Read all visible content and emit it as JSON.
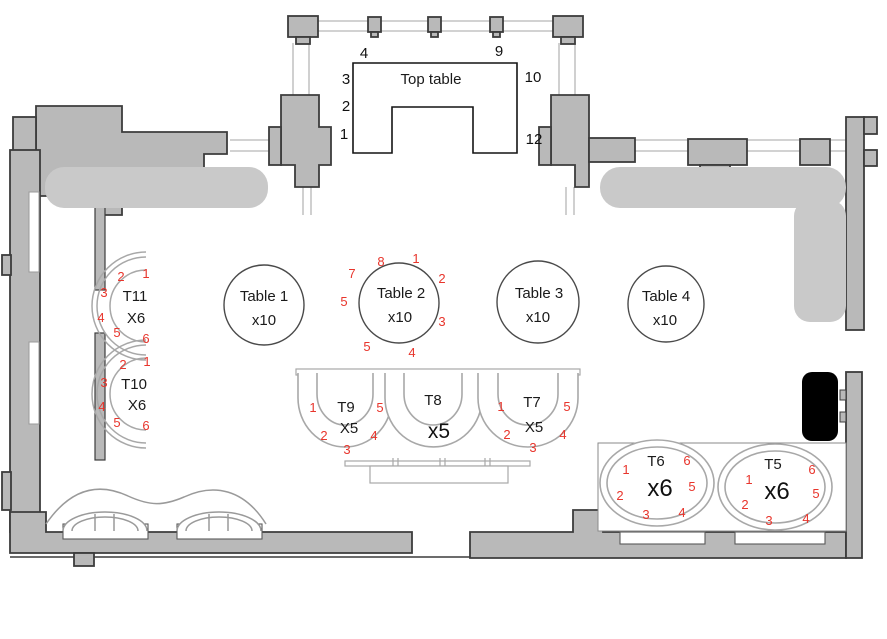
{
  "colors": {
    "wall_fill": "#b9b9b9",
    "wall_outline": "#3c3c3c",
    "thin_wall_line": "#c4c4c4",
    "lounge_fill": "#c9c9c9",
    "furniture_outline": "#a8a8a8",
    "table_outline": "#4a4a4a",
    "seat_number": "#e8352c",
    "label_text": "#1a1a1a",
    "black_object": "#000000"
  },
  "tables": {
    "top": {
      "label": "Top table",
      "seats": {
        "n4": "4",
        "n9": "9",
        "n3": "3",
        "n2": "2",
        "n1": "1",
        "n10": "10",
        "n12": "12"
      }
    },
    "t1": {
      "label": "Table 1",
      "cap": "x10"
    },
    "t2": {
      "label": "Table 2",
      "cap": "x10",
      "seats": {
        "top": "8",
        "top_right": "1",
        "upper_left": "7",
        "right": "2",
        "left": "5",
        "lower_right": "3",
        "bottom_left": "5",
        "bottom": "4"
      }
    },
    "t3": {
      "label": "Table 3",
      "cap": "x10"
    },
    "t4": {
      "label": "Table 4",
      "cap": "x10"
    },
    "t11": {
      "label": "T11",
      "cap": "X6",
      "seats": {
        "s1": "1",
        "s2": "2",
        "s3": "3",
        "s4": "4",
        "s5": "5",
        "s6": "6"
      }
    },
    "t10": {
      "label": "T10",
      "cap": "X6",
      "seats": {
        "s1": "1",
        "s2": "2",
        "s3": "3",
        "s4": "4",
        "s5": "5",
        "s6": "6"
      }
    },
    "t9": {
      "label": "T9",
      "cap": "X5",
      "seats": {
        "s1": "1",
        "s2": "2",
        "s3": "3",
        "s4": "4",
        "s5": "5"
      }
    },
    "t8": {
      "label": "T8",
      "cap": "x5"
    },
    "t7": {
      "label": "T7",
      "cap": "X5",
      "seats": {
        "s1": "1",
        "s2": "2",
        "s3": "3",
        "s4": "4",
        "s5": "5"
      }
    },
    "t6": {
      "label": "T6",
      "cap": "x6",
      "seats": {
        "s1": "1",
        "s2": "2",
        "s3": "3",
        "s4": "4",
        "s5": "5",
        "s6": "6"
      }
    },
    "t5": {
      "label": "T5",
      "cap": "x6",
      "seats": {
        "s1": "1",
        "s2": "2",
        "s3": "3",
        "s4": "4",
        "s5": "5",
        "s6": "6"
      }
    }
  }
}
